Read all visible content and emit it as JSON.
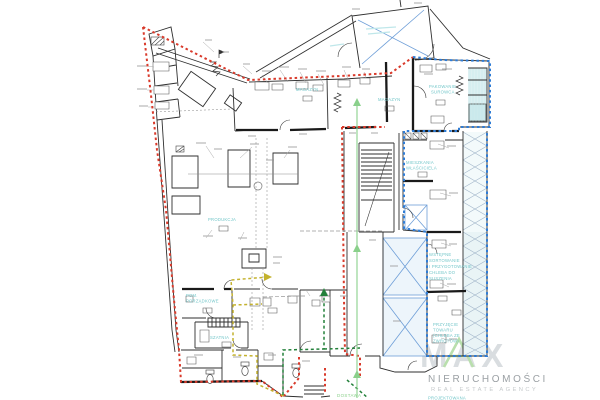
{
  "document": {
    "type": "architectural-floor-plan",
    "description": "Ground floor plan of a bakery building with boundary overlays"
  },
  "labels": {
    "magazyn_left": "MAGAZYN",
    "magazyn_right": "MAGAZYN",
    "pakowanie_1": "PAKOWANIE",
    "pakowanie_2": "SUROWCA",
    "mieszkania_1": "MIESZKANIA",
    "mieszkania_2": "WŁAŚCICIELA",
    "produkcja": "PRODUKCJA",
    "pom_1": "POM.",
    "pom_2": "PORZĄDKOWE",
    "szatnia": "SZATNIA",
    "wstepne_1": "WSTĘPNE",
    "wstepne_2": "SORTOWANIE",
    "wstepne_3": "I PRZYGOTOWANIE",
    "wstepne_4": "CHLEBA DO",
    "wstepne_5": "SUSZENIA",
    "przyjecie_1": "PRZYJĘCIE",
    "przyjecie_2": "TOWARU",
    "przyjecie_3": "(CHLEBA ZE",
    "przyjecie_4": "ZWROTÓW)",
    "dostawa": "DOSTAWA",
    "projektowana": "PROJEKTOWANA"
  },
  "watermark": {
    "logo": "MAX",
    "name": "NIERUCHOMOŚCI",
    "tagline": "REAL ESTATE AGENCY"
  },
  "colors": {
    "boundary_red": "#d93a2b",
    "boundary_blue": "#2e7cd6",
    "route_yellow": "#c4b22e",
    "route_green_dark": "#23803a",
    "route_green_light": "#8ad08b",
    "label_teal": "#72c6c9",
    "wall_black": "#2f2f2f",
    "crossing_blue": "#6f9fd8",
    "watermark_gray": "#d9dde0",
    "watermark_green": "#b9dfad"
  }
}
